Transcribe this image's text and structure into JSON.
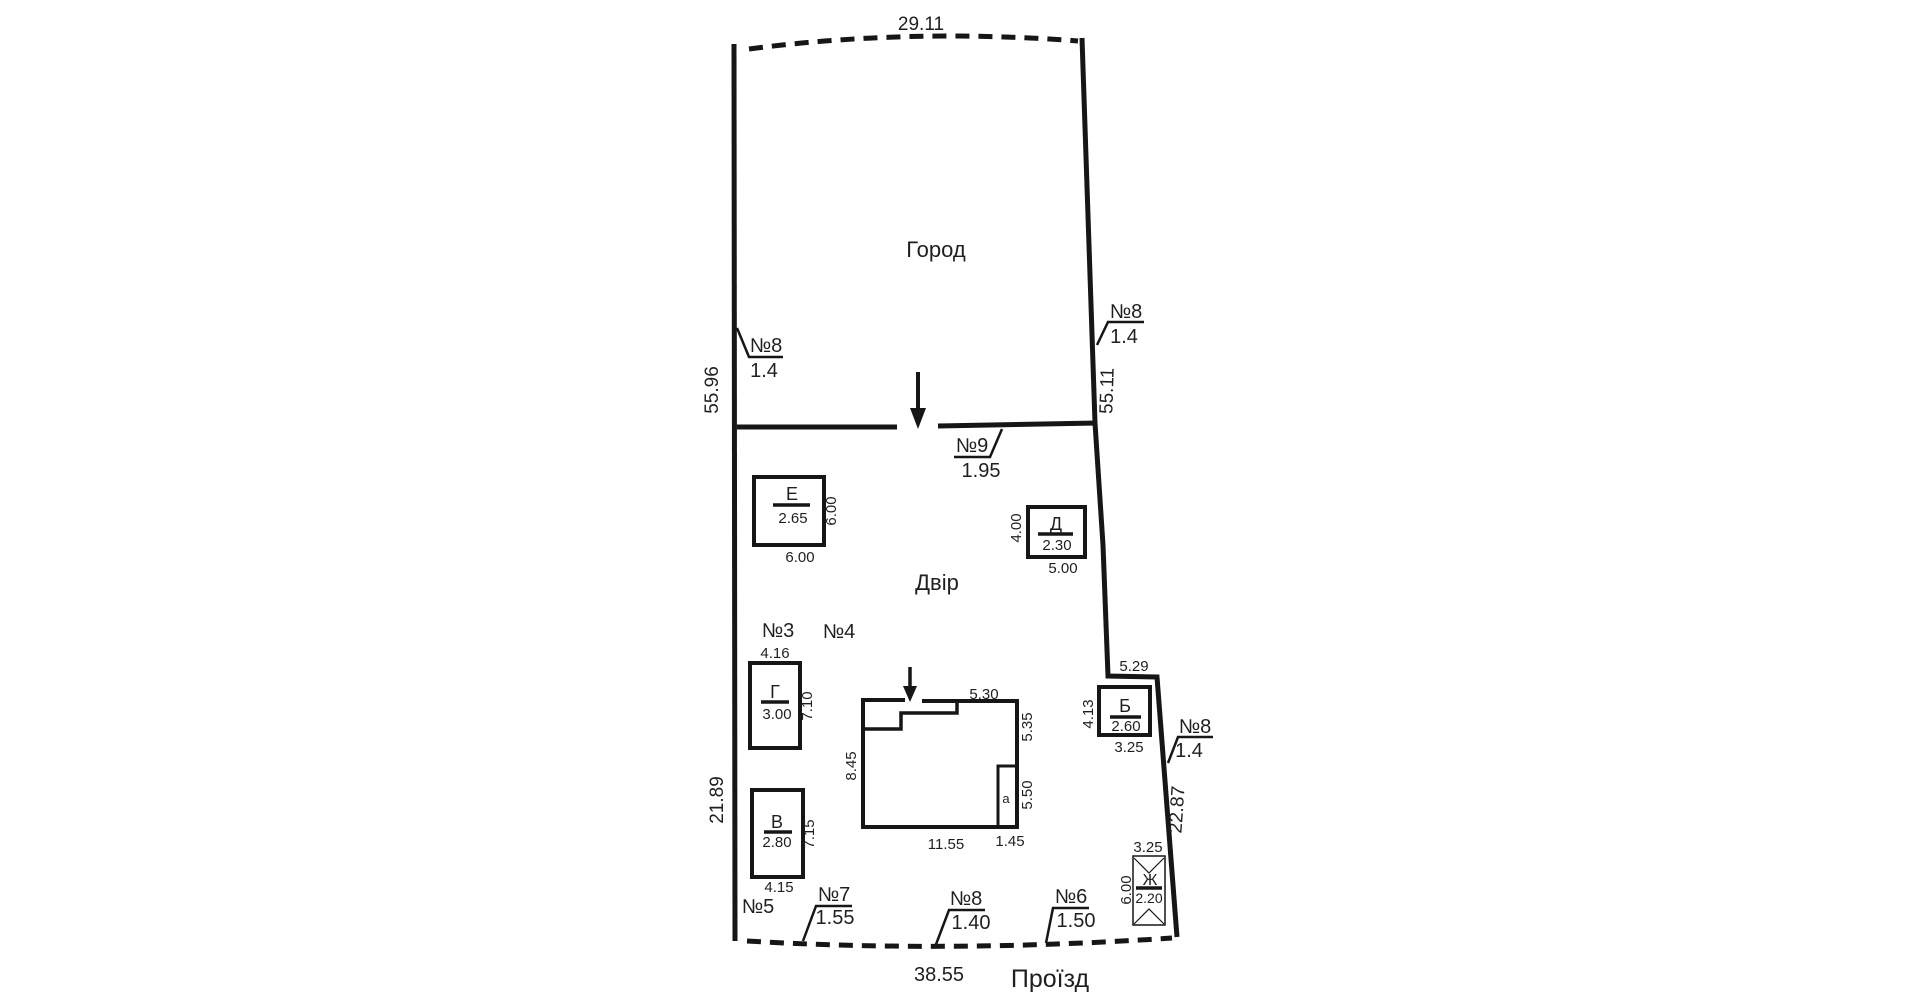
{
  "areas": {
    "garden": "Город",
    "yard": "Двір",
    "passage": "Проїзд"
  },
  "boundary": {
    "top": "29.11",
    "left_upper": "55.96",
    "left_lower": "21.89",
    "right_upper": "55.11",
    "right_lower": "22.87",
    "right_jog": "5.29",
    "bottom": "38.55"
  },
  "fences": {
    "left": {
      "no": "№8",
      "w": "1.4"
    },
    "right": {
      "no": "№8",
      "w": "1.4"
    },
    "gate": {
      "no": "№9",
      "w": "1.95"
    },
    "near_b": {
      "no": "№8",
      "w": "1.4"
    },
    "no3": "№3",
    "no4": "№4",
    "no5": "№5",
    "bottom1": {
      "no": "№7",
      "w": "1.55"
    },
    "bottom2": {
      "no": "№8",
      "w": "1.40"
    },
    "bottom3": {
      "no": "№6",
      "w": "1.50"
    }
  },
  "buildings": {
    "E": {
      "letter": "Е",
      "h": "2.65",
      "side": "6.00",
      "bottom": "6.00"
    },
    "D": {
      "letter": "Д",
      "h": "2.30",
      "side": "4.00",
      "bottom": "5.00"
    },
    "G": {
      "letter": "Г",
      "h": "3.00",
      "top": "4.16",
      "side": "7.10"
    },
    "V": {
      "letter": "В",
      "h": "2.80",
      "side": "7.15",
      "bottom": "4.15"
    },
    "B": {
      "letter": "Б",
      "h": "2.60",
      "side": "4.13",
      "bottom": "3.25"
    },
    "Zh": {
      "letter": "Ж",
      "h": "2.20",
      "top": "3.25",
      "side": "6.00"
    },
    "house": {
      "room": "a",
      "top": "5.30",
      "right_upper": "5.35",
      "right_lower": "5.50",
      "left": "8.45",
      "bottom": "11.55",
      "bottom_right": "1.45"
    }
  }
}
